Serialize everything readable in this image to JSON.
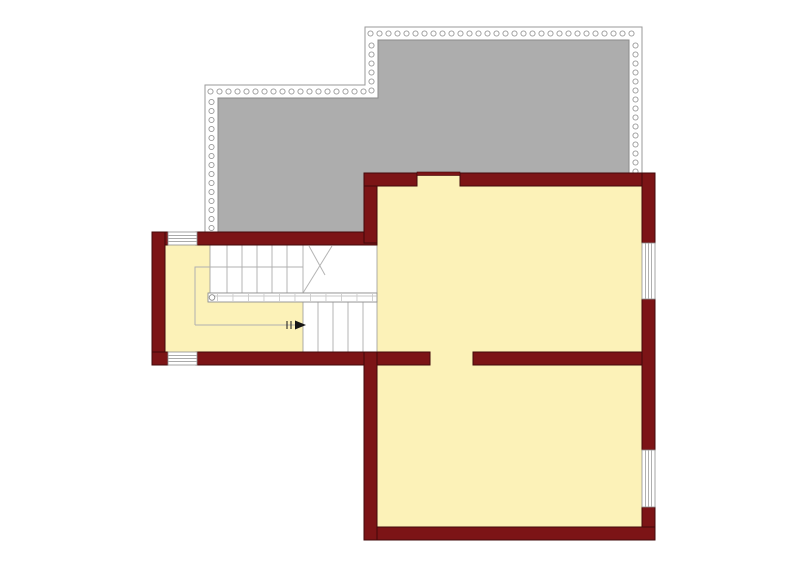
{
  "page": {
    "title": "Floor plan drawing",
    "background": "#ffffff"
  },
  "colors": {
    "wall": "#7c1416",
    "wall_edge": "#420809",
    "floor": "#fcf2b8",
    "terrace": "#adadad",
    "terrace_edge": "#8a8a8a",
    "line": "#9a9a9a",
    "stair_line": "#b5b5b5",
    "arrow": "#161616",
    "bg": "#ffffff",
    "win_edge": "#8f8f8f",
    "rail_tick": "#cccccc"
  },
  "plan": {
    "rooms_filled": 3,
    "terrace_present": true,
    "window_count": 4,
    "door_openings": 2,
    "stair": {
      "flights": 2,
      "direction_arrow": "right",
      "handrail": true
    }
  }
}
